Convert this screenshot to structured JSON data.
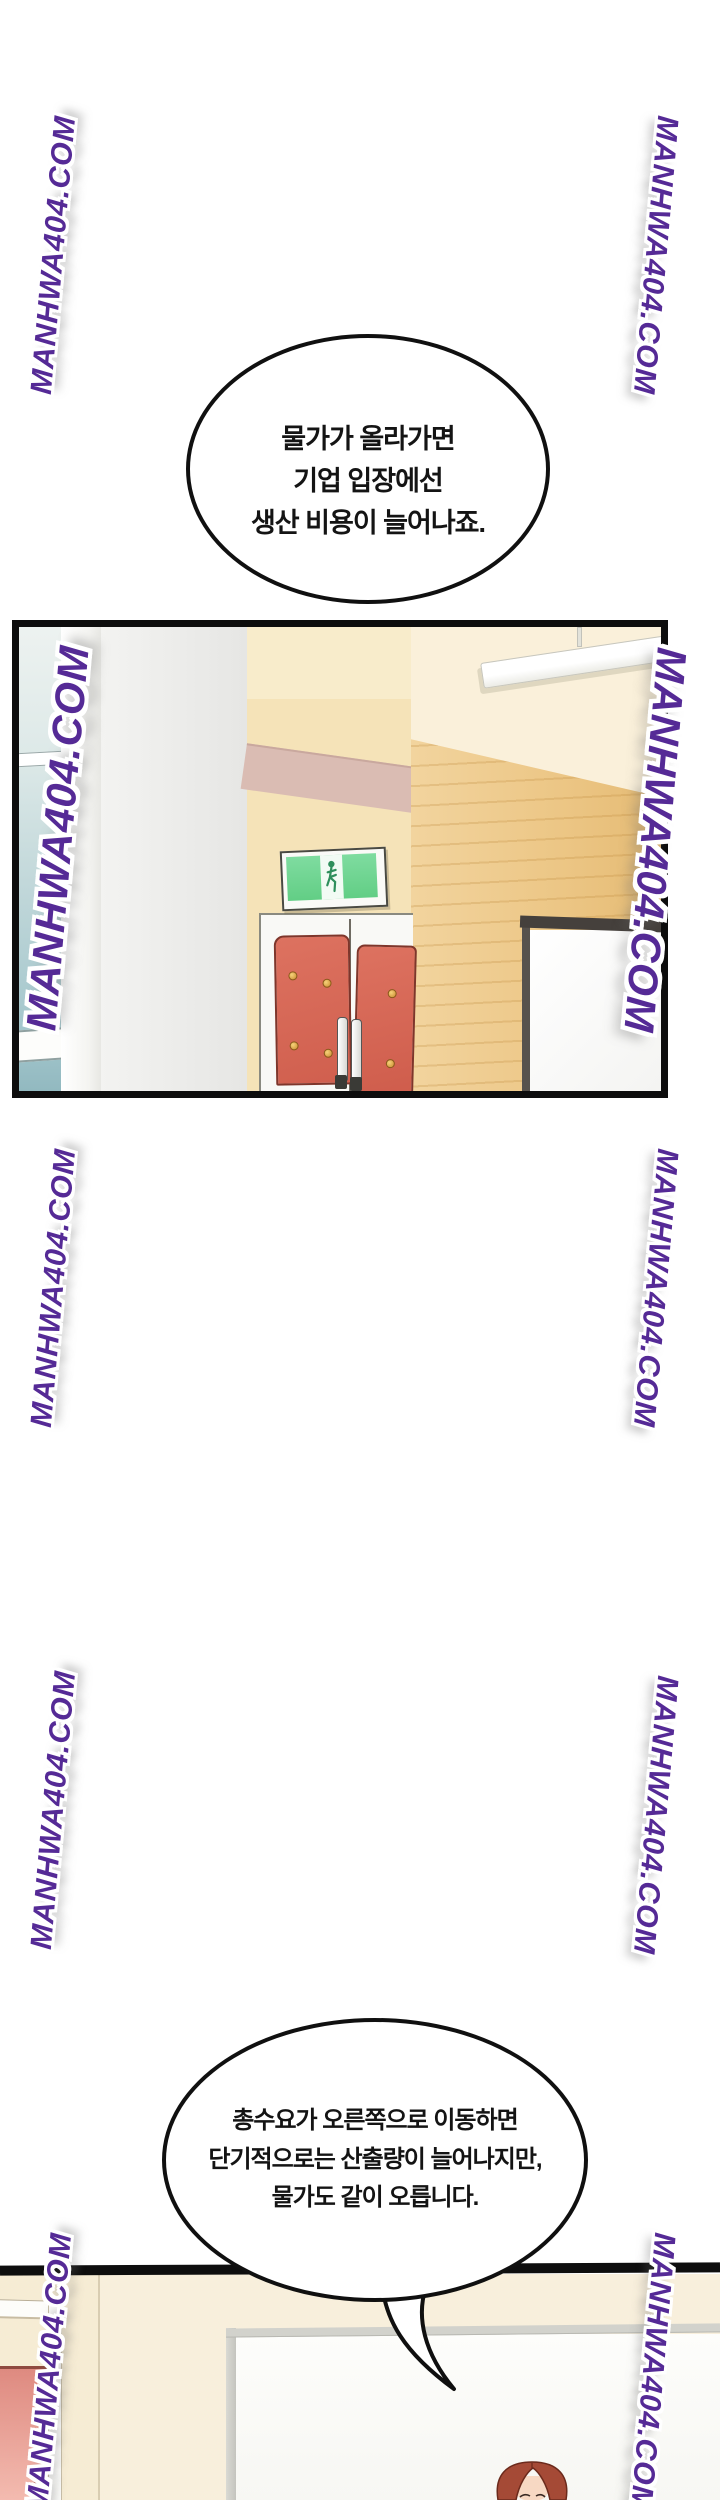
{
  "page": {
    "width": 720,
    "height": 2500,
    "background": "#ffffff"
  },
  "watermark": {
    "text": "MANHWA404.COM",
    "color": "#552a96",
    "halo_color": "#ffffff"
  },
  "speech_bubbles": [
    {
      "id": "bubble-1",
      "lines": [
        "물가가 올라가면",
        "기업 입장에선",
        "생산 비용이 늘어나죠."
      ]
    },
    {
      "id": "bubble-2",
      "lines": [
        "총수요가 오른쪽으로 이동하면",
        "단기적으로는 산출량이 늘어나지만,",
        "물가도 같이 오릅니다."
      ]
    }
  ],
  "panels": [
    {
      "id": "panel-1",
      "scene": "hallway with green exit sign above red double doors, wood wall, whiteboard and fluorescent light"
    },
    {
      "id": "panel-2",
      "scene": "classroom wall with whiteboard, pink door and red-haired woman with glasses at bottom"
    }
  ],
  "icons": {
    "exit_sign": "running-man-icon"
  },
  "colors": {
    "watermark_purple": "#552a96",
    "panel_border": "#0d0d0d",
    "exit_sign_green": "#72d794",
    "door_red": "#d8695a",
    "wood": "#efcc92",
    "wall_cream": "#f8efdc",
    "pink_door": "#e8998f",
    "glass_teal": "#a3c6cc",
    "hair_auburn": "#a54a36"
  }
}
